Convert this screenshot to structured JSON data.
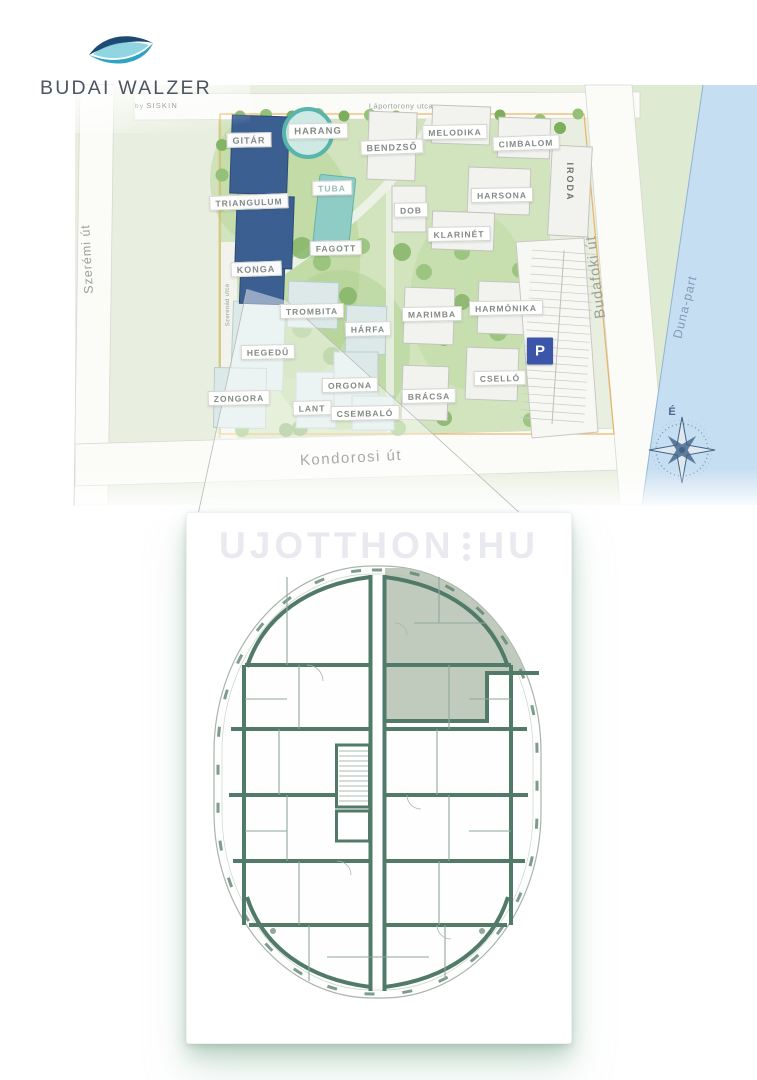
{
  "logo": {
    "title": "BUDAI WALZER",
    "byline_prefix": "by",
    "byline_brand": "SISKIN"
  },
  "watermark": {
    "left": "UJOTTHON",
    "right": "HU"
  },
  "map": {
    "labels": [
      {
        "id": "laportorony-utca",
        "text": "Láportorony utca",
        "type": "street",
        "x": 401,
        "y": 106,
        "rot": 0,
        "size": 7.5,
        "ls": 0.5
      },
      {
        "id": "szeremi-ut",
        "text": "Szerémi út",
        "type": "street",
        "x": 87,
        "y": 259,
        "rot": -93,
        "size": 12.5,
        "ls": 1
      },
      {
        "id": "kondorosi-ut",
        "text": "Kondorosi út",
        "type": "street",
        "x": 351,
        "y": 458,
        "rot": -3,
        "size": 15,
        "ls": 1.5,
        "color": "#a6aba4"
      },
      {
        "id": "budafoki-ut",
        "text": "Budafoki út",
        "type": "street",
        "x": 596,
        "y": 277,
        "rot": -97,
        "size": 14.5,
        "ls": 1
      },
      {
        "id": "szerenad-utca",
        "text": "Szerenád utca",
        "type": "street",
        "x": 228,
        "y": 305,
        "rot": -91,
        "size": 6,
        "ls": 0.3
      },
      {
        "id": "duna-part",
        "text": "Duna-part",
        "type": "street",
        "x": 685,
        "y": 307,
        "rot": -76,
        "size": 12.5,
        "ls": 1,
        "color": "#7e9cb8"
      },
      {
        "id": "gitar",
        "text": "GITÁR",
        "type": "chip",
        "x": 249,
        "y": 140,
        "rot": -1,
        "size": 9
      },
      {
        "id": "harang",
        "text": "HARANG",
        "type": "chip",
        "x": 318,
        "y": 131,
        "rot": -1,
        "size": 9.5
      },
      {
        "id": "triangulum",
        "text": "TRIANGULUM",
        "type": "chip",
        "x": 249,
        "y": 202,
        "rot": -2,
        "size": 8.5
      },
      {
        "id": "konga",
        "text": "KONGA",
        "type": "chip",
        "x": 256,
        "y": 269,
        "rot": -2,
        "size": 9
      },
      {
        "id": "tuba",
        "text": "TUBA",
        "type": "chip",
        "x": 332,
        "y": 188,
        "rot": -1,
        "size": 8.5,
        "color": "#9dbcb8"
      },
      {
        "id": "fagott",
        "text": "FAGOTT",
        "type": "chip",
        "x": 336,
        "y": 248,
        "rot": -1,
        "size": 8.5
      },
      {
        "id": "bendzso",
        "text": "BENDZSŐ",
        "type": "chip",
        "x": 392,
        "y": 147,
        "rot": -2,
        "size": 9
      },
      {
        "id": "melodika",
        "text": "MELODIKA",
        "type": "chip",
        "x": 455,
        "y": 132,
        "rot": -1,
        "size": 8.5
      },
      {
        "id": "cimbalom",
        "text": "CIMBALOM",
        "type": "chip",
        "x": 526,
        "y": 143,
        "rot": -2,
        "size": 8.5
      },
      {
        "id": "harsona",
        "text": "HARSONA",
        "type": "chip",
        "x": 502,
        "y": 195,
        "rot": -1,
        "size": 8.5
      },
      {
        "id": "dob",
        "text": "DOB",
        "type": "chip",
        "x": 411,
        "y": 210,
        "rot": -1,
        "size": 8.5
      },
      {
        "id": "klarinet",
        "text": "KLARINÉT",
        "type": "chip",
        "x": 459,
        "y": 234,
        "rot": -1,
        "size": 8.5
      },
      {
        "id": "iroda",
        "text": "IRODA",
        "type": "plain",
        "x": 570,
        "y": 182,
        "rot": 90,
        "size": 9,
        "ls": 2
      },
      {
        "id": "trombita",
        "text": "TROMBITA",
        "type": "chip",
        "x": 312,
        "y": 311,
        "rot": -1,
        "size": 8.5
      },
      {
        "id": "harfa",
        "text": "HÁRFA",
        "type": "chip",
        "x": 368,
        "y": 329,
        "rot": -1,
        "size": 8.5
      },
      {
        "id": "hegedu",
        "text": "HEGEDŰ",
        "type": "chip",
        "x": 268,
        "y": 352,
        "rot": -1,
        "size": 8.5
      },
      {
        "id": "marimba",
        "text": "MARIMBA",
        "type": "chip",
        "x": 432,
        "y": 314,
        "rot": -1,
        "size": 8.5
      },
      {
        "id": "harmonika",
        "text": "HARMÓNIKA",
        "type": "chip",
        "x": 506,
        "y": 308,
        "rot": -1,
        "size": 8.5
      },
      {
        "id": "csello",
        "text": "CSELLÓ",
        "type": "chip",
        "x": 500,
        "y": 378,
        "rot": -1,
        "size": 8.5
      },
      {
        "id": "bracsa",
        "text": "BRÁCSA",
        "type": "chip",
        "x": 429,
        "y": 396,
        "rot": -1,
        "size": 8.5
      },
      {
        "id": "zongora",
        "text": "ZONGORA",
        "type": "chip",
        "x": 239,
        "y": 398,
        "rot": -1,
        "size": 8.5
      },
      {
        "id": "orgona",
        "text": "ORGONA",
        "type": "chip",
        "x": 350,
        "y": 385,
        "rot": -1,
        "size": 8.5
      },
      {
        "id": "lant",
        "text": "LANT",
        "type": "chip",
        "x": 312,
        "y": 408,
        "rot": -1,
        "size": 8.5
      },
      {
        "id": "csembalo",
        "text": "CSEMBALÓ",
        "type": "chip",
        "x": 365,
        "y": 413,
        "rot": -1,
        "size": 8.5
      },
      {
        "id": "parking",
        "text": "P",
        "type": "parking",
        "x": 540,
        "y": 351,
        "rot": 0,
        "size": 15
      },
      {
        "id": "compass-north",
        "text": "É",
        "type": "compass",
        "x": 672,
        "y": 412,
        "rot": 0,
        "size": 11
      }
    ]
  },
  "colors": {
    "brand_navy": "#1d4a73",
    "brand_teal": "#2fa3c4",
    "building_navy": "#3c5f92",
    "building_teal": "#57b5ab",
    "wall_green": "#517a69",
    "water_blue": "#c6def1",
    "parking_blue": "#3b55a8",
    "boundary_orange": "#e8a23c",
    "highlight_unit": "#b5c2b2"
  }
}
